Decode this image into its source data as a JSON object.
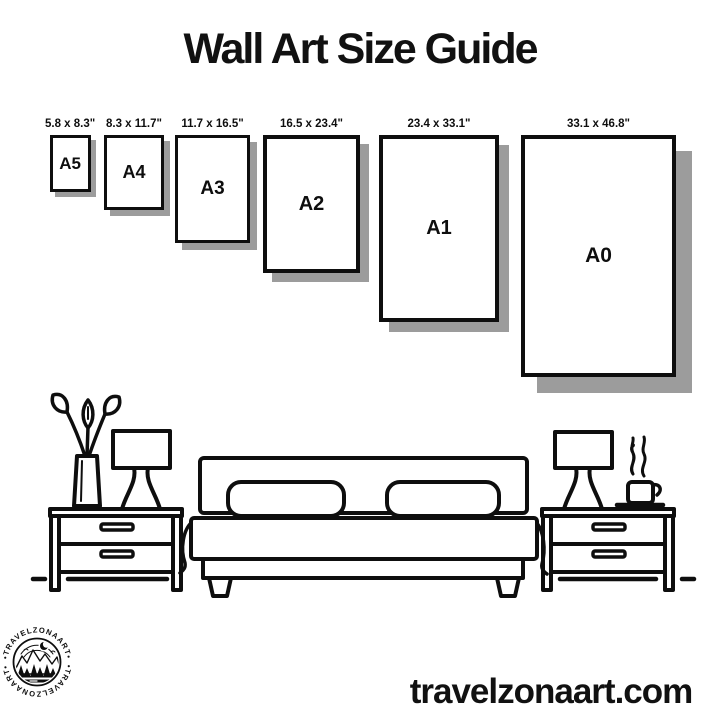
{
  "page": {
    "background": "#ffffff",
    "ink_color": "#0e0e0e",
    "shadow_color": "#9c9c9c"
  },
  "header": {
    "title": "Wall Art Size Guide"
  },
  "size_guide": {
    "frames": [
      {
        "label": "A5",
        "size": "5.8 x 8.3\""
      },
      {
        "label": "A4",
        "size": "8.3 x 11.7\""
      },
      {
        "label": "A3",
        "size": "11.7 x 16.5\""
      },
      {
        "label": "A2",
        "size": "16.5 x 23.4\""
      },
      {
        "label": "A1",
        "size": "23.4 x 33.1\""
      },
      {
        "label": "A0",
        "size": "33.1 x 46.8\""
      }
    ]
  },
  "illustration": {
    "icons": [
      "plant-vase-icon",
      "table-lamp-icon",
      "nightstand-icon",
      "bed-icon",
      "coffee-cup-icon",
      "floor-line"
    ]
  },
  "logo": {
    "brand": "TRAVELZONAART",
    "arc_text_top": "•TRAVELZONAART•",
    "arc_text_bottom": "•TRAVELZONAART•"
  },
  "footer": {
    "website": "travelzonaart.com"
  }
}
